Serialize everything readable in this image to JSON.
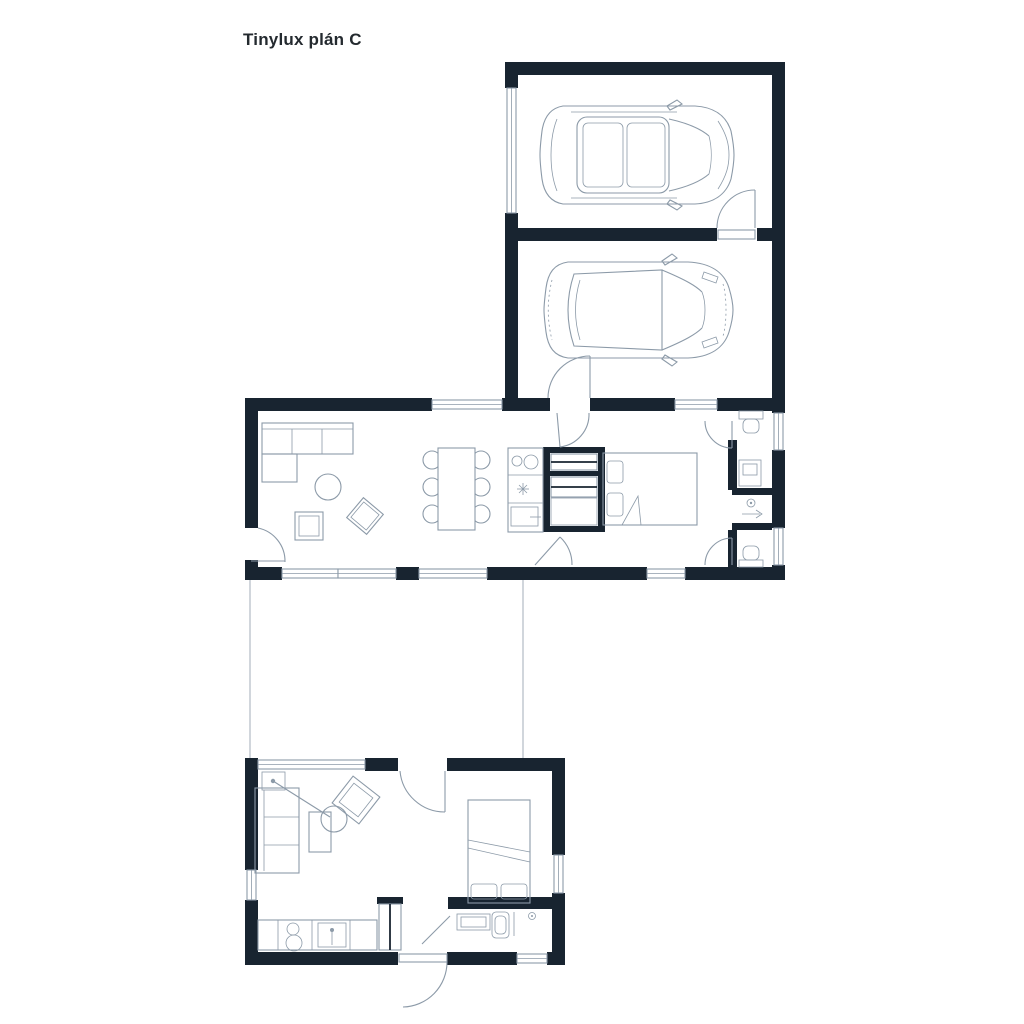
{
  "title": "Tinylux plán C",
  "colors": {
    "background": "#ffffff",
    "wall": "#182430",
    "line": "#8c9aa8",
    "title_text": "#242a2f"
  }
}
